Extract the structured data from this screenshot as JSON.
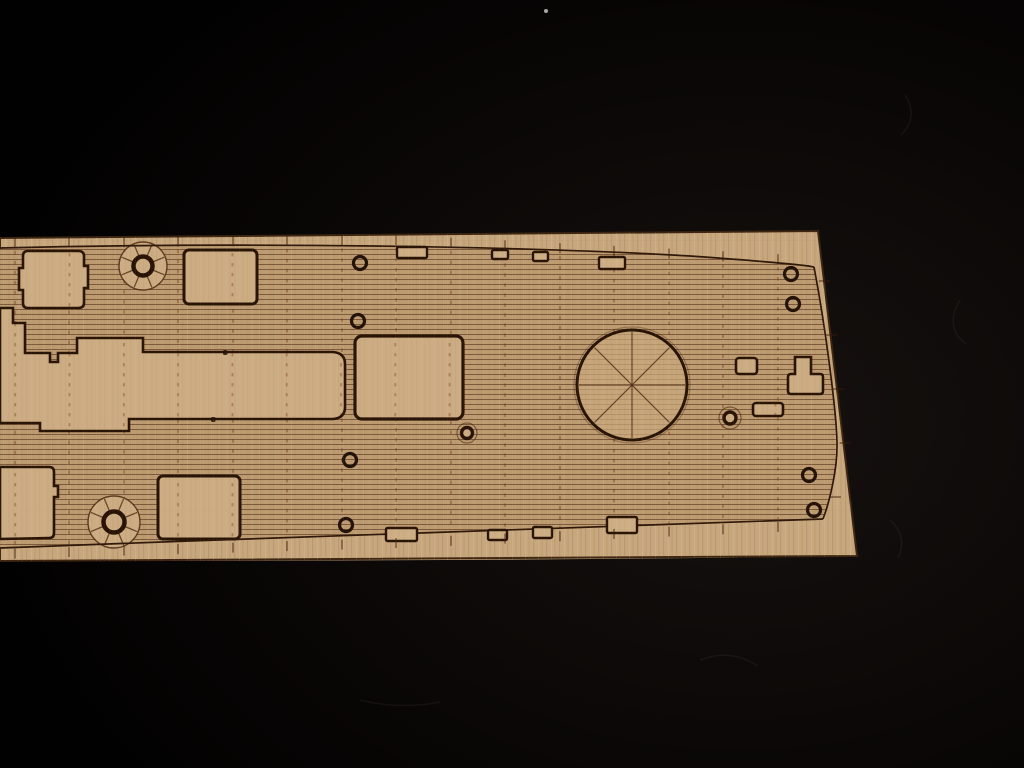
{
  "meta": {
    "subject": "laser-etched wooden model ship deck sheet photographed on black felt",
    "width": 1024,
    "height": 768
  },
  "palette": {
    "background": "#050303",
    "background_glow": "#171210",
    "board_fill": "#cdae84",
    "board_edge": "#3a2410",
    "plank_base": "#c2a176",
    "plank_line": "rgba(80,48,24,0.62)",
    "smooth_fill": "#d2b389",
    "outline": "#2b1608",
    "feature_stroke": "#241104",
    "caulk": "rgba(112,48,22,0.55)",
    "tick": "rgba(60,28,12,0.75)",
    "grain_light": "rgba(255,240,215,0.10)",
    "grain_dark": "rgba(110,75,40,0.10)",
    "spoke": "rgba(75,45,20,0.8)",
    "tab_fill": "#d4b68c",
    "speck": "#cfd2c9"
  },
  "board": {
    "path": "M0,238 L818,231 L857,556 C600,560 300,561 0,561 Z"
  },
  "deck_region": {
    "path": "M0,249 C260,242 540,247 700,257 C770,262 808,265 814,267 C826,330 836,410 837,441 C838,471 828,506 823,519 C640,524 300,537 0,548 Z"
  },
  "outlines": {
    "top": "M0,248 C250,242 520,246 690,256 C760,261 806,265 814,267",
    "right": "M814,267 C826,330 836,410 837,441 C838,471 828,506 823,519",
    "bottom": "M823,519 C640,524 300,537 0,548"
  },
  "caulk": {
    "xs": [
      15,
      69,
      124,
      178,
      233,
      287,
      342,
      396,
      451,
      505,
      560,
      614,
      669,
      723,
      778
    ],
    "top_pts": [
      [
        0,
        249
      ],
      [
        400,
        246
      ],
      [
        814,
        267
      ]
    ],
    "bottom_pts": [
      [
        0,
        548
      ],
      [
        400,
        537
      ],
      [
        823,
        519
      ]
    ],
    "dash": "3.5 6.5"
  },
  "right_ticks": {
    "ys": [
      281,
      335,
      389,
      443,
      497
    ],
    "pts": [
      [
        267,
        814
      ],
      [
        441,
        837
      ],
      [
        519,
        823
      ]
    ]
  },
  "features": {
    "band": {
      "path": "M0,308 L13,308 L13,323 L25,323 L25,353 L50,353 L50,362 L58,362 L58,353 L77,353 L77,338 L143,338 L143,352 L333,352 Q345,353 345,364 L345,407 Q345,418 333,419 L129,419 L129,431 L40,431 L40,423 L0,423 Z",
      "nubs": [
        [
          223,
          350
        ],
        [
          211,
          417
        ]
      ]
    },
    "hatch_notched_tl": {
      "path": "M28,251 L78,251 Q84,251 84,256 L84,266 L88,266 L88,288 L84,288 L84,303 Q84,308 78,308 L28,308 Q23,308 23,303 L23,290 L19,290 L19,268 L23,268 L23,256 Q23,251 28,251 Z"
    },
    "hatch_notched_bl": {
      "path": "M0,467 L49,467 Q54,467 54,472 L54,486 L58,486 L58,497 L54,497 L54,533 Q54,538 49,538 L0,539 Z"
    },
    "tee": {
      "path": "M795,357 L811,357 L811,374 L820,374 Q823,374 823,377 L823,391 Q823,394 820,394 L791,394 Q788,394 788,391 L788,377 Q788,374 791,374 L795,374 Z"
    },
    "rect_hatches": [
      {
        "name": "hatch-rect-top",
        "x": 184,
        "y": 250,
        "w": 73,
        "h": 54,
        "rx": 5,
        "sw": 3
      },
      {
        "name": "hatch-rect-bottom",
        "x": 158,
        "y": 476,
        "w": 82,
        "h": 63,
        "rx": 5,
        "sw": 3
      },
      {
        "name": "hatch-rect-main",
        "x": 355,
        "y": 336,
        "w": 108,
        "h": 83,
        "rx": 7,
        "sw": 3.2
      },
      {
        "name": "fitting-rect-small",
        "x": 736,
        "y": 358,
        "w": 21,
        "h": 16,
        "rx": 3,
        "sw": 2.6
      },
      {
        "name": "fitting-rect-wide",
        "x": 753,
        "y": 403,
        "w": 30,
        "h": 13,
        "rx": 3,
        "sw": 2.6
      }
    ],
    "barbette": {
      "cx": 632,
      "cy": 385,
      "r": 55
    },
    "capstans": [
      {
        "cx": 143,
        "cy": 266,
        "ro": 24,
        "ri": 9.5
      },
      {
        "cx": 114,
        "cy": 522,
        "ro": 26,
        "ri": 10.5
      }
    ],
    "ringed_circles": [
      {
        "cx": 467,
        "cy": 433,
        "ro": 10,
        "ri": 5.5
      },
      {
        "cx": 730,
        "cy": 418,
        "ro": 11,
        "ri": 6
      }
    ],
    "ring_bolts": [
      [
        360,
        263
      ],
      [
        358,
        321
      ],
      [
        350,
        460
      ],
      [
        346,
        525
      ],
      [
        791,
        274
      ],
      [
        793,
        304
      ],
      [
        809,
        475
      ],
      [
        814,
        510
      ]
    ],
    "edge_tabs": [
      [
        397,
        247,
        30,
        11
      ],
      [
        492,
        250,
        16,
        9
      ],
      [
        533,
        252,
        15,
        9
      ],
      [
        599,
        257,
        26,
        12
      ],
      [
        386,
        528,
        31,
        13
      ],
      [
        488,
        530,
        19,
        10
      ],
      [
        533,
        527,
        19,
        11
      ],
      [
        607,
        517,
        30,
        16
      ]
    ]
  },
  "background_details": {
    "speck": {
      "x": 546,
      "y": 11,
      "r": 2
    },
    "lint": [
      "M905,95 q14,22 -4,40",
      "M960,300 q-16,28 6,44",
      "M700,660 q30,-12 58,6",
      "M360,700 q40,10 80,2",
      "M890,520 q18,16 8,38"
    ]
  }
}
